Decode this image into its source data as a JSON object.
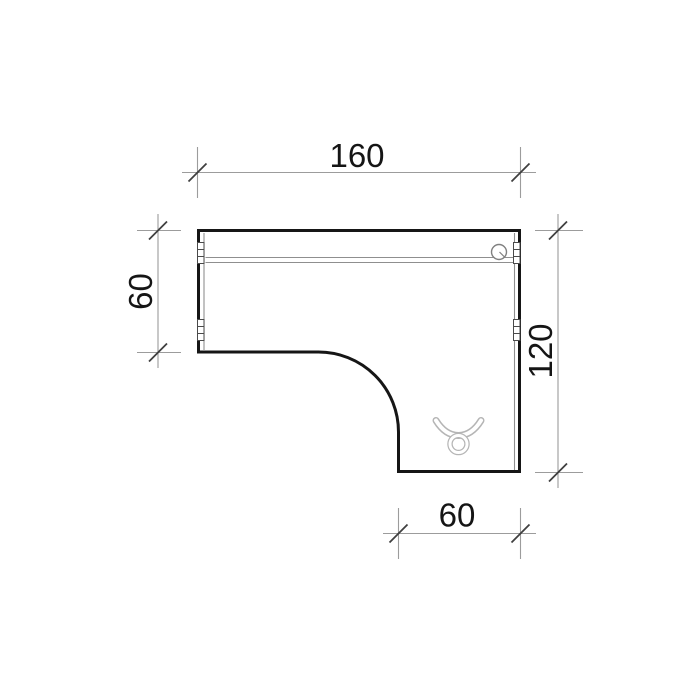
{
  "dimensions": {
    "top_width": "160",
    "left_depth": "60",
    "right_depth": "120",
    "bottom_width": "60"
  },
  "colors": {
    "background": "#ffffff",
    "desk_outline": "#161616",
    "dimension_line": "#9c9c9c",
    "tick_mark": "#3f3f3f",
    "label_text": "#151515",
    "panel_detail": "#8f8f8f",
    "icon_gray": "#b5b5b5"
  },
  "icons": [
    {
      "name": "cable-grommet-icon"
    },
    {
      "name": "taurus-cable-clip-icon"
    },
    {
      "name": "panel-connector-icon"
    }
  ]
}
